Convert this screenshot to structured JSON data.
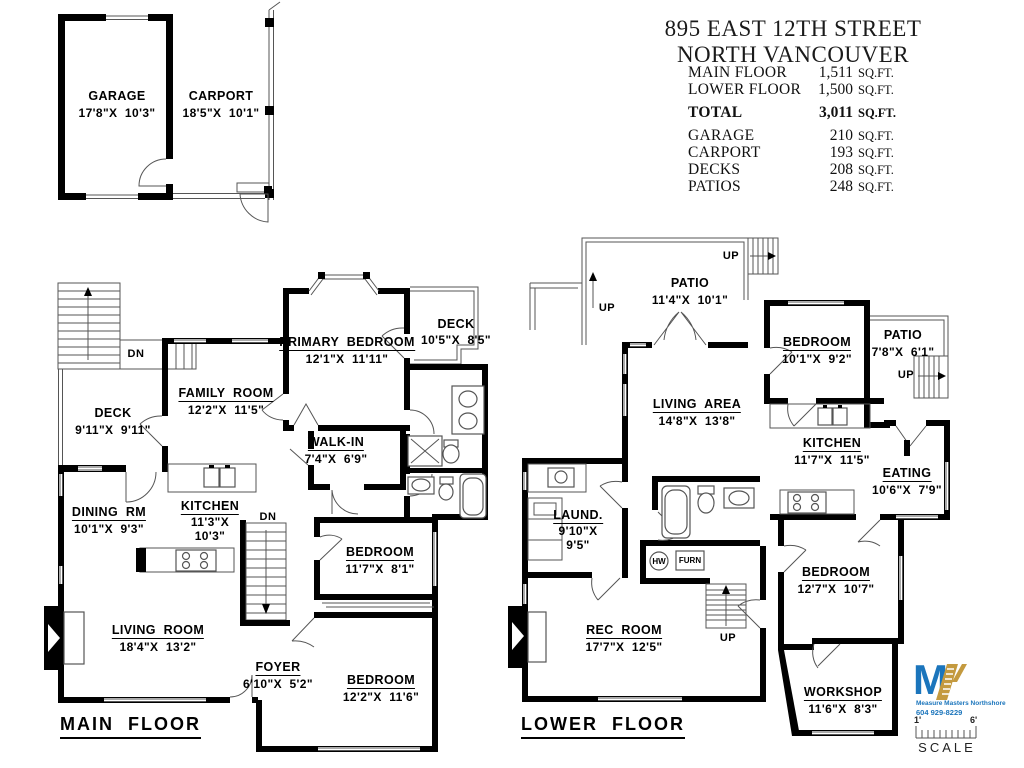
{
  "title": {
    "line1": "895 EAST 12TH STREET",
    "line2": "NORTH VANCOUVER"
  },
  "area_table": {
    "rows": [
      {
        "label": "MAIN FLOOR",
        "value": "1,511",
        "unit": "SQ.FT."
      },
      {
        "label": "LOWER FLOOR",
        "value": "1,500",
        "unit": "SQ.FT."
      },
      {
        "label": "TOTAL",
        "value": "3,011",
        "unit": "SQ.FT."
      },
      {
        "label": "GARAGE",
        "value": "210",
        "unit": "SQ.FT."
      },
      {
        "label": "CARPORT",
        "value": "193",
        "unit": "SQ.FT."
      },
      {
        "label": "DECKS",
        "value": "208",
        "unit": "SQ.FT."
      },
      {
        "label": "PATIOS",
        "value": "248",
        "unit": "SQ.FT."
      }
    ]
  },
  "garage_plan": {
    "garage": {
      "name": "GARAGE",
      "dims": "17'8\"X  10'3\""
    },
    "carport": {
      "name": "CARPORT",
      "dims": "18'5\"X  10'1\""
    }
  },
  "main_floor": {
    "label": "MAIN  FLOOR",
    "rooms": {
      "primary_bedroom": {
        "name": "PRIMARY  BEDROOM",
        "dims": "12'1\"X  11'11\""
      },
      "deck_upper": {
        "name": "DECK",
        "dims": "10'5\"X  8'5\""
      },
      "family_room": {
        "name": "FAMILY  ROOM",
        "dims": "12'2\"X  11'5\""
      },
      "deck_left": {
        "name": "DECK",
        "dims": "9'11\"X  9'11\""
      },
      "walk_in": {
        "name": "WALK-IN",
        "dims": "7'4\"X  6'9\""
      },
      "dining_rm": {
        "name": "DINING  RM",
        "dims": "10'1\"X  9'3\""
      },
      "kitchen": {
        "name": "KITCHEN",
        "dims_line1": "11'3\"X",
        "dims_line2": "10'3\""
      },
      "bedroom_small": {
        "name": "BEDROOM",
        "dims": "11'7\"X  8'1\""
      },
      "living_room": {
        "name": "LIVING  ROOM",
        "dims": "18'4\"X  13'2\""
      },
      "foyer": {
        "name": "FOYER",
        "dims": "6'10\"X  5'2\""
      },
      "bedroom_large": {
        "name": "BEDROOM",
        "dims": "12'2\"X  11'6\""
      }
    }
  },
  "lower_floor": {
    "label": "LOWER  FLOOR",
    "rooms": {
      "patio_top": {
        "name": "PATIO",
        "dims": "11'4\"X  10'1\""
      },
      "bedroom_top": {
        "name": "BEDROOM",
        "dims": "10'1\"X  9'2\""
      },
      "patio_right": {
        "name": "PATIO",
        "dims": "7'8\"X  6'1\""
      },
      "living_area": {
        "name": "LIVING  AREA",
        "dims": "14'8\"X  13'8\""
      },
      "kitchen": {
        "name": "KITCHEN",
        "dims": "11'7\"X  11'5\""
      },
      "eating": {
        "name": "EATING",
        "dims": "10'6\"X  7'9\""
      },
      "laundry": {
        "name": "LAUND.",
        "dims_line1": "9'10\"X",
        "dims_line2": "9'5\""
      },
      "bedroom_mid": {
        "name": "BEDROOM",
        "dims": "12'7\"X  10'7\""
      },
      "rec_room": {
        "name": "REC  ROOM",
        "dims": "17'7\"X  12'5\""
      },
      "workshop": {
        "name": "WORKSHOP",
        "dims": "11'6\"X  8'3\""
      }
    }
  },
  "annotations": {
    "dn": "DN",
    "up": "UP",
    "hw": "HW",
    "furn": "FURN"
  },
  "logo": {
    "monogram": "M",
    "company": "Measure Masters Northshore",
    "phone": "604 929-8229"
  },
  "scale_bar": {
    "left": "1'",
    "right": "6'",
    "label": "SCALE"
  },
  "colors": {
    "wall": "#000000",
    "thin_line": "#555555",
    "logo_blue": "#1b75bc",
    "logo_gold": "#c49a3f"
  }
}
